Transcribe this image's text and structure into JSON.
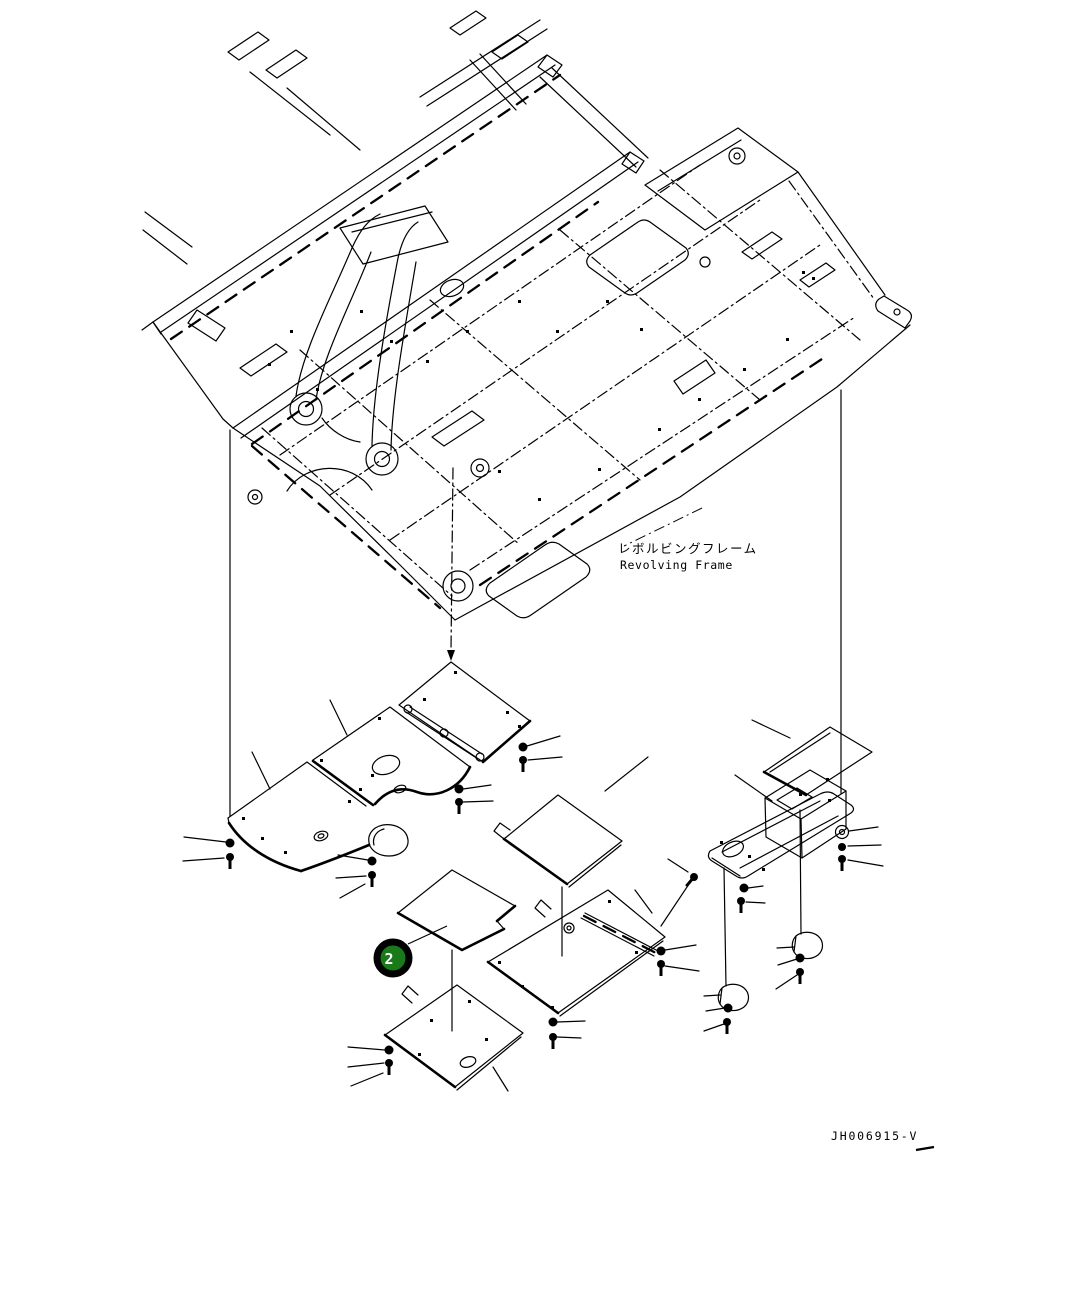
{
  "page": {
    "background": "#ffffff",
    "line_color": "#000000"
  },
  "frame_label": {
    "ja": "レボルビングフレーム",
    "en": "Revolving Frame"
  },
  "callout": {
    "number": "2",
    "fill_color": "#1a7a1a",
    "ring_color": "#000000",
    "text_color": "#ffffff"
  },
  "footer": {
    "drawing_number": "JH006915-V"
  }
}
